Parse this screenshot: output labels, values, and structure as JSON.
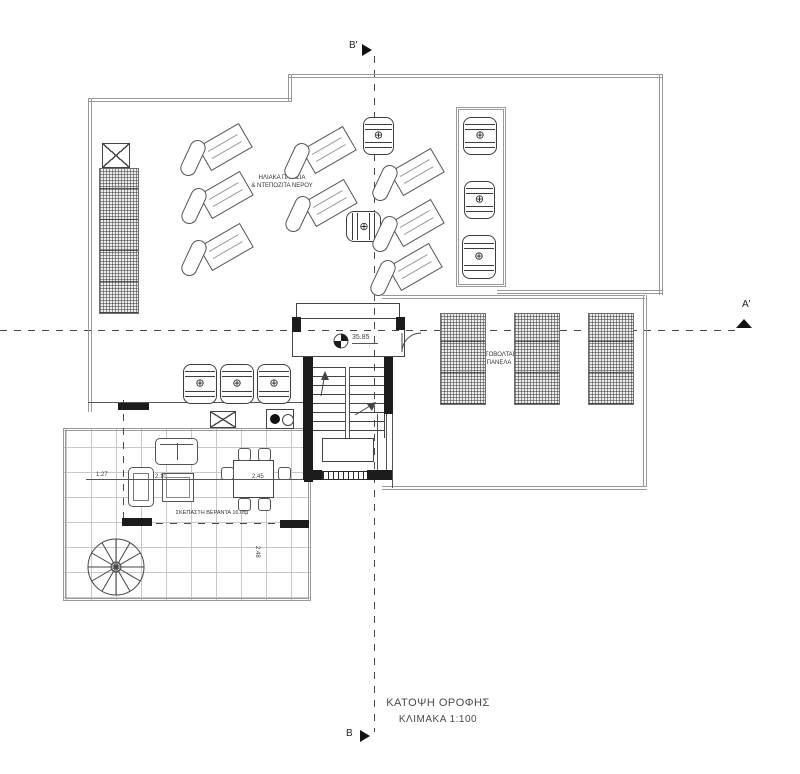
{
  "drawing": {
    "title": {
      "line1": "ΚΑΤΟΨΗ ΟΡΟΦΗΣ",
      "line2": "ΚΛΙΜΑΚΑ 1:100"
    },
    "section_markers": {
      "top": "Β'",
      "bottom": "Β",
      "right": "Α'"
    },
    "labels": {
      "solar_line1": "ΗΛΙΑΚΑ ΠΛΑΙΣΙΑ",
      "solar_line2": "& ΝΤΕΠΟΖΙΤΑ ΝΕΡΟΥ",
      "pv_line1": "ΦΩΤΟΒΟΛΤΑΪΚΑ",
      "pv_line2": "ΠΑΝΕΛΑ",
      "veranda": "ΣΚΕΠΑΣΤΗ ΒΕΡΑΝΤΑ 16.0τμ",
      "level": "35.85"
    },
    "dimensions": {
      "d1": "1.27",
      "d2": "2.10",
      "d3": "2.45",
      "d4": "2.48"
    },
    "icons": {
      "tank_cap": "⊕"
    },
    "colors": {
      "ink": "#3c3c3c",
      "boundary": "#97999b",
      "paper": "#ffffff",
      "wall_fill": "#1c1c1c"
    }
  },
  "plan_geometry": {
    "solar_pairs": [
      [
        183,
        127
      ],
      [
        287,
        130
      ],
      [
        184,
        175
      ],
      [
        288,
        183
      ],
      [
        184,
        227
      ],
      [
        375,
        152
      ],
      [
        375,
        203
      ],
      [
        373,
        247
      ]
    ],
    "tanks": [
      [
        363,
        117,
        31,
        38,
        0
      ],
      [
        348,
        209,
        31,
        35,
        1
      ],
      [
        463,
        117,
        34,
        38,
        0
      ],
      [
        464,
        181,
        31,
        38,
        0
      ],
      [
        462,
        235,
        34,
        44,
        0
      ],
      [
        183,
        364,
        34,
        40,
        0
      ],
      [
        220,
        364,
        34,
        40,
        0
      ],
      [
        257,
        364,
        34,
        40,
        0
      ]
    ],
    "pv_panels": [
      [
        440,
        313,
        46,
        92
      ],
      [
        514,
        313,
        46,
        92
      ],
      [
        588,
        313,
        46,
        92
      ],
      [
        99,
        168,
        40,
        146
      ]
    ],
    "walls": [
      [
        303,
        357,
        10,
        123
      ],
      [
        384,
        357,
        9,
        57
      ],
      [
        303,
        470,
        19,
        10
      ],
      [
        367,
        470,
        25,
        10
      ],
      [
        292,
        317,
        9,
        15
      ],
      [
        396,
        317,
        9,
        13
      ],
      [
        118,
        403,
        31,
        7
      ],
      [
        122,
        518,
        30,
        8
      ],
      [
        280,
        520,
        29,
        8
      ],
      [
        304,
        462,
        9,
        20
      ]
    ],
    "dlines": [
      [
        288,
        74,
        375,
        "h"
      ],
      [
        659,
        74,
        221,
        "v"
      ],
      [
        288,
        74,
        28,
        "v"
      ],
      [
        88,
        98,
        203,
        "h"
      ],
      [
        88,
        98,
        314,
        "v"
      ],
      [
        497,
        290,
        166,
        "h"
      ],
      [
        382,
        295,
        263,
        "h"
      ],
      [
        643,
        295,
        192,
        "v"
      ],
      [
        382,
        486,
        265,
        "h"
      ]
    ],
    "tlines": [
      [
        345,
        367,
        71,
        "v"
      ],
      [
        349,
        367,
        71,
        "v"
      ],
      [
        377,
        414,
        58,
        "v"
      ],
      [
        386,
        412,
        62,
        "v"
      ],
      [
        392,
        412,
        76,
        "v"
      ],
      [
        88,
        402,
        220,
        "h"
      ],
      [
        86,
        479,
        222,
        "h"
      ],
      [
        352,
        343,
        26,
        "h"
      ],
      [
        123,
        400,
        123,
        "dv"
      ]
    ],
    "chairs": [
      [
        238,
        448
      ],
      [
        258,
        448
      ],
      [
        221,
        467
      ],
      [
        278,
        467
      ],
      [
        238,
        498
      ],
      [
        258,
        498
      ]
    ]
  }
}
